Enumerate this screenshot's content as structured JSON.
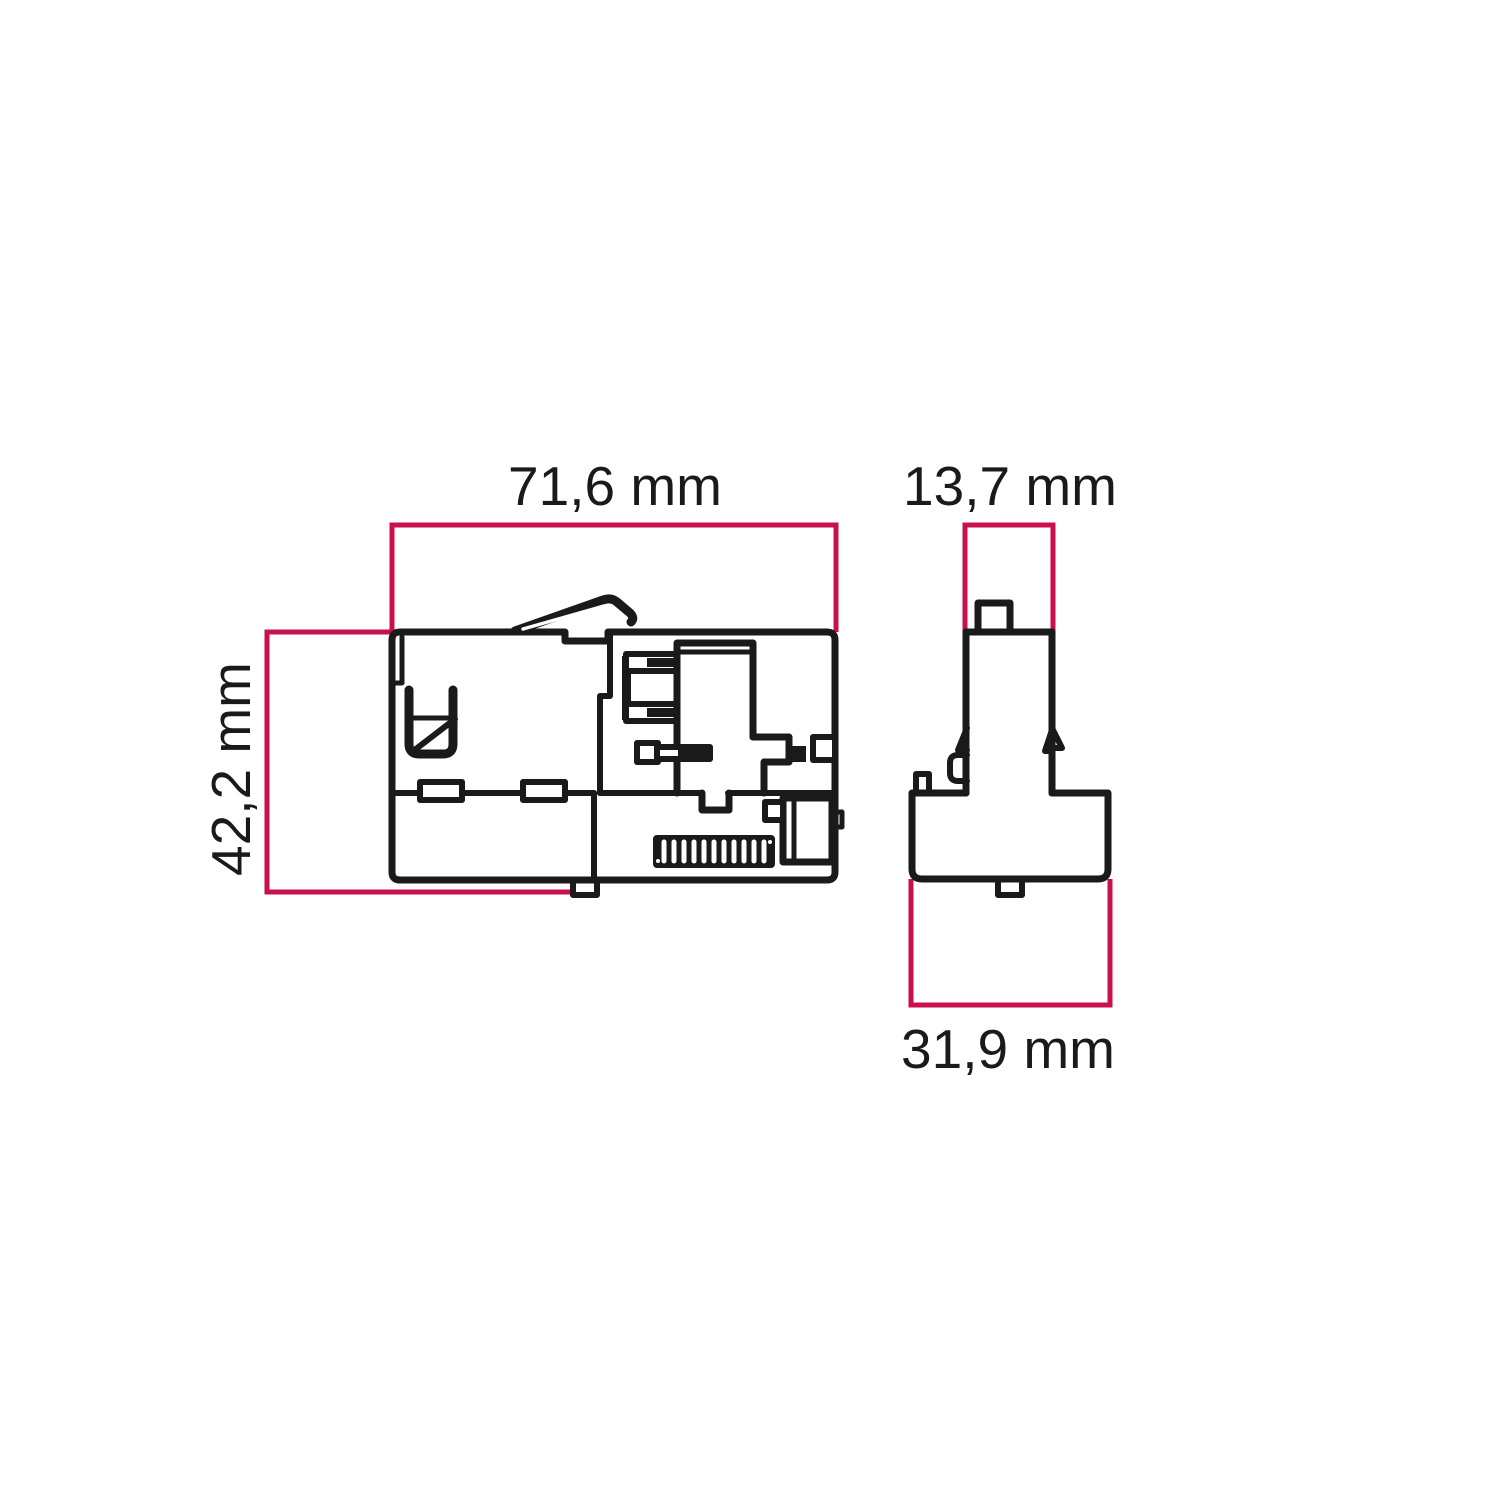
{
  "drawing": {
    "type": "technical dimension drawing",
    "subject": "track adapter connector shown in front and side orthographic views",
    "colors": {
      "outline": "#1a1a1a",
      "dimension": "#c8104e",
      "fill": "#ffffff"
    },
    "views": {
      "front": {
        "name": "front view"
      },
      "side": {
        "name": "side view"
      }
    },
    "dimensions": {
      "front_width": {
        "label": "71,6 mm",
        "orientation": "horizontal"
      },
      "front_height": {
        "label": "42,2 mm",
        "orientation": "vertical"
      },
      "side_top_width": {
        "label": "13,7 mm",
        "orientation": "horizontal"
      },
      "side_bottom_width": {
        "label": "31,9 mm",
        "orientation": "horizontal"
      }
    }
  }
}
